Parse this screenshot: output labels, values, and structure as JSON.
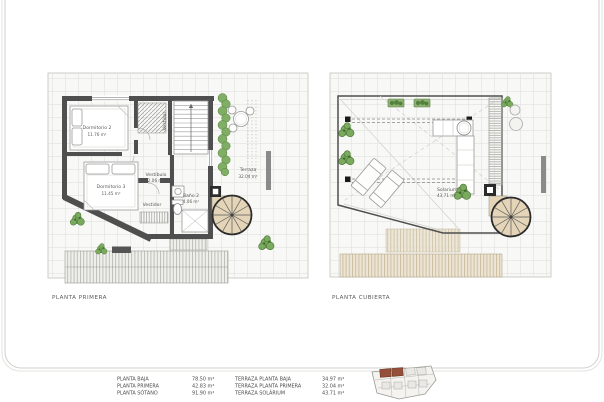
{
  "plans": [
    {
      "id": "planta-primera",
      "title": "PLANTA PRIMERA",
      "rooms": [
        {
          "name": "Dormitorio 2",
          "area": "11.76 m²"
        },
        {
          "name": "Dormitorio 3",
          "area": "11.45 m²"
        },
        {
          "name": "Vestíbulo",
          "area": "2.06 m²"
        },
        {
          "name": "Vestidor",
          "area": ""
        },
        {
          "name": "Vestidor",
          "area": ""
        },
        {
          "name": "Baño 2",
          "area": "4.06 m²"
        },
        {
          "name": "Terraza",
          "area": "32.04 m²"
        }
      ]
    },
    {
      "id": "planta-cubierta",
      "title": "PLANTA CUBIERTA",
      "rooms": [
        {
          "name": "Solarium",
          "area": "43.71 m²"
        }
      ]
    }
  ],
  "legend": {
    "columns": [
      {
        "rows": [
          {
            "label": "PLANTA BAJA",
            "value": "78.50 m²"
          },
          {
            "label": "PLANTA PRIMERA",
            "value": "42.83 m²"
          },
          {
            "label": "PLANTA SÓTANO",
            "value": "91.90 m²"
          }
        ]
      },
      {
        "rows": [
          {
            "label": "TERRAZA PLANTA BAJA",
            "value": "34.97 m²"
          },
          {
            "label": "TERRAZA PLANTA PRIMERA",
            "value": "32.04 m²"
          },
          {
            "label": "TERRAZA SOLÁRIUM",
            "value": "43.71 m²"
          }
        ]
      }
    ]
  },
  "colors": {
    "wall": "#4f4f4f",
    "grid_line": "#dddddb",
    "plan_background": "#f8f8f6",
    "plant_green": "#79aa5d",
    "stair_tan": "#e4d5b8",
    "lot_brown": "#96503a"
  }
}
